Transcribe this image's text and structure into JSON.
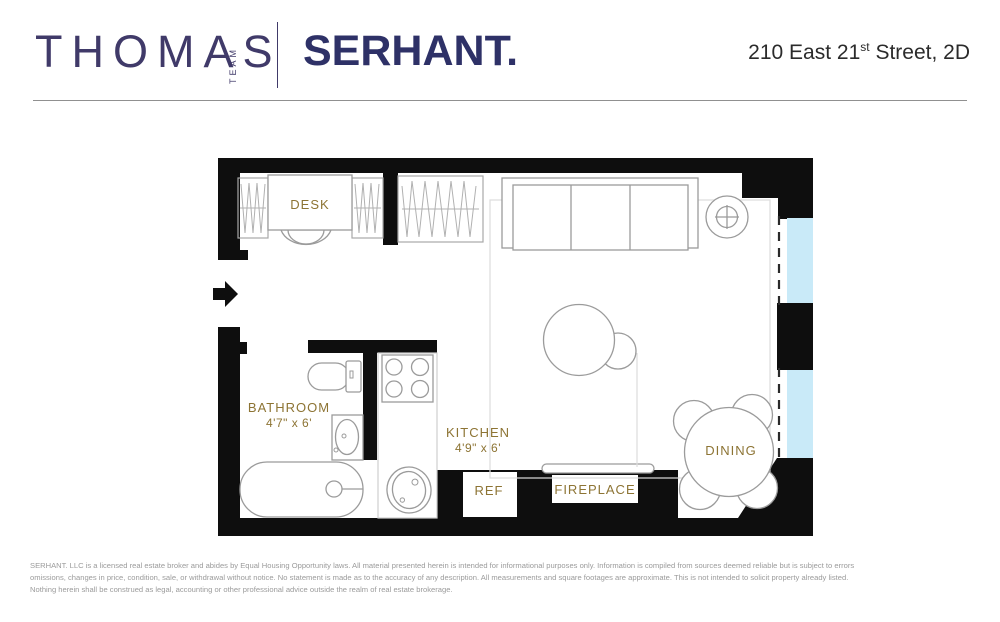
{
  "header": {
    "brand_primary": "THOMAS",
    "brand_secondary": "TEAM",
    "brand_partner": "SERHANT.",
    "address": {
      "before": "210 East 21",
      "superscript": "st",
      "after": " Street, 2D"
    }
  },
  "floorplan": {
    "labels": {
      "desk": "DESK",
      "bathroom": "BATHROOM",
      "bathroom_dims": "4'7\" x 6'",
      "kitchen": "KITCHEN",
      "kitchen_dims": "4'9\" x 6'",
      "ref": "REF",
      "fireplace": "FIREPLACE",
      "dining": "DINING"
    },
    "colors": {
      "wall": "#0e0e0e",
      "window": "#c9eaf8",
      "label_text": "#8d7434",
      "furniture_outline": "#9b9b9b"
    }
  },
  "footer": {
    "lines": [
      "SERHANT. LLC is a licensed real estate broker and abides by Equal Housing Opportunity laws. All material presented herein is intended for informational purposes only. Information is compiled from sources deemed reliable but is subject to errors",
      "omissions, changes in price, condition, sale, or withdrawal without notice. No statement is made as to the accuracy of any description. All measurements and square footages are approximate. This is not intended to solicit property already listed.",
      "Nothing herein shall be construed as legal, accounting or other professional advice outside the realm of real estate brokerage."
    ]
  }
}
